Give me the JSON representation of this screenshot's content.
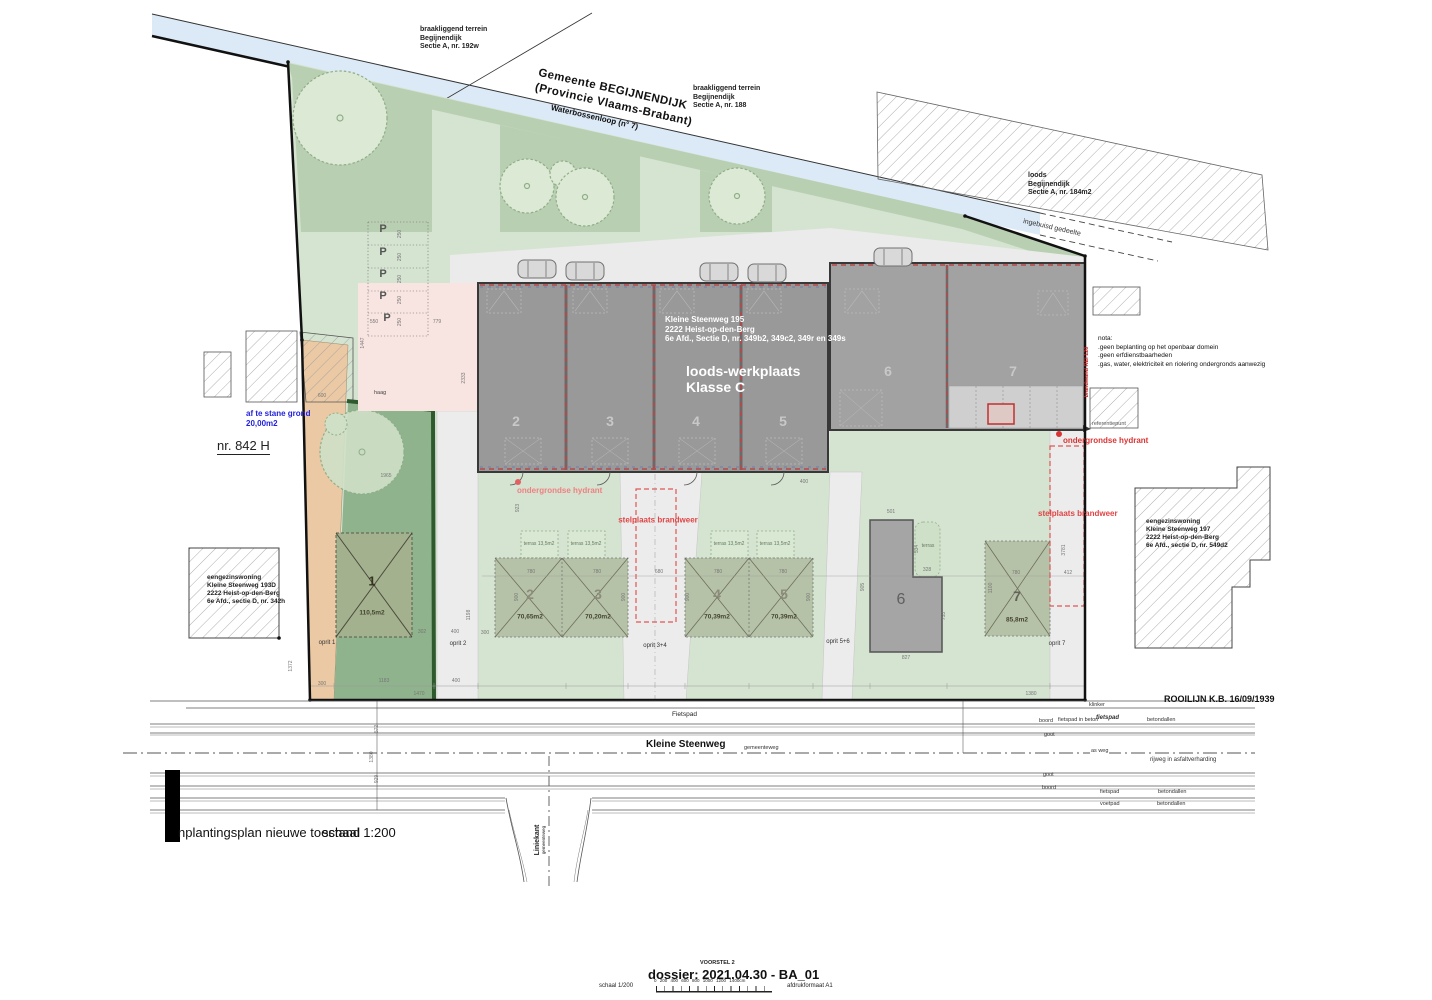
{
  "plan": {
    "parcel_nw": "braakliggend terrein\nBegijnendijk\nSectie A, nr. 192w",
    "parcel_n": "braakliggend terrein\nBegijnendijk\nSectie A, nr. 188",
    "parcel_ne": "loods\nBegijnendijk\nSectie A, nr. 184m2",
    "municipality_line1": "Gemeente BEGIJNENDIJK",
    "municipality_line2": "(Provincie Vlaams-Brabant)",
    "waterway": "Waterbossenloop (n° 7)",
    "buried_section": "ingebuisd gedeelte",
    "building_address": "Kleine Steenweg 195\n2222  Heist-op-den-Berg\n6e Afd., Sectie D, nr. 349b2, 349c2, 349r en 349s",
    "building_title": "loods-werkplaats\nKlasse C",
    "nota": "nota:\n.geen beplanting op het openbaar domein\n.geen erfdienstbaarheden\n.gas, water, elektriciteit en riolering ondergronds aanwezig",
    "firewall": "brandwand REI 120",
    "cede_land": "af te stane grond\n20,00m2",
    "parcel_nr": "nr. 842 H",
    "hedge": "haag",
    "hydrant_left": "ondergrondse hydrant",
    "hydrant_right": "ondergrondse hydrant",
    "reference_point": "referentiepunt",
    "fire_bay_center": "stelplaats brandweer",
    "fire_bay_right": "stelplaats brandweer",
    "house_left": "eengezinswoning\nKleine Steenweg 193D\n2222 Heist-op-den-Berg\n6e Afd., sectie D, nr. 342h",
    "house_right": "eengezinswoning\nKleine Steenweg 197\n2222 Heist-op-den-Berg\n6e Afd., sectie D, nr. 549d2"
  },
  "road": {
    "rooilijn": "ROOILIJN K.B. 16/09/1939",
    "fietspad": "Fietspad",
    "street_name": "Kleine Steenweg",
    "street_type": "gemeenteweg",
    "klinker": "klinker",
    "boord1": "boord",
    "boord2": "boord",
    "goot1": "goot",
    "goot2": "goot",
    "as_weg": "as weg",
    "rijweg": "rijweg in asfaltverharding",
    "fietspad_beton": "fietspad in beton",
    "fietspad_bold": "fietspad",
    "betondallen1": "betondallen",
    "betondallen2": "betondallen",
    "betondallen3": "betondallen",
    "fietspad2": "fietspad",
    "voetpad": "voetpad",
    "liniekant": "Liniekant",
    "liniekant_sub": "gemeenteweg"
  },
  "title_block": {
    "title": "nplantingsplan  nieuwe toestand",
    "scale": "schaal 1:200"
  },
  "footer": {
    "voorstel": "VOORSTEL 2",
    "dossier": "dossier: 2021.04.30  -  BA_01",
    "scale": "schaal 1/200",
    "ruler_labels": "0   200  400  600  800  1000 1200 1400cm",
    "format": "afdrukformaat A1"
  },
  "colors": {
    "water": "#dce9f6",
    "site_green": "#d5e3d1",
    "strip_green": "#b9cfb2",
    "building_gray": "#999999",
    "lot_green": "#8fb38c",
    "pink_zone": "#f8e4e0",
    "tan_drive": "#eac9a4",
    "red_accent": "#e04545",
    "blue_note": "#2222dd"
  },
  "annotations": {
    "p_label": "P",
    "p_marks": [
      {
        "x": 383,
        "y": 229
      },
      {
        "x": 383,
        "y": 252
      },
      {
        "x": 383,
        "y": 274
      },
      {
        "x": 383,
        "y": 296
      },
      {
        "x": 387,
        "y": 318
      }
    ],
    "stalls": [
      {
        "t": "2",
        "x": 516,
        "y": 421
      },
      {
        "t": "3",
        "x": 610,
        "y": 421
      },
      {
        "t": "4",
        "x": 696,
        "y": 421
      },
      {
        "t": "5",
        "x": 783,
        "y": 421
      },
      {
        "t": "6",
        "x": 888,
        "y": 371
      },
      {
        "t": "7",
        "x": 1013,
        "y": 371
      }
    ],
    "lots": [
      {
        "no": "1",
        "area": "110,5m2",
        "x": 372,
        "ny": 581,
        "ay": 613,
        "style": "dark"
      },
      {
        "no": "2",
        "area": "70,65m2",
        "x": 530,
        "ny": 594,
        "ay": 617,
        "style": "mid"
      },
      {
        "no": "3",
        "area": "70,20m2",
        "x": 598,
        "ny": 594,
        "ay": 617,
        "style": "mid"
      },
      {
        "no": "4",
        "area": "70,39m2",
        "x": 717,
        "ny": 594,
        "ay": 617,
        "style": "mid"
      },
      {
        "no": "5",
        "area": "70,39m2",
        "x": 784,
        "ny": 594,
        "ay": 617,
        "style": "mid"
      },
      {
        "no": "6",
        "area": "",
        "x": 901,
        "ny": 600,
        "ay": 0,
        "style": "onbldg"
      },
      {
        "no": "7",
        "area": "85,8m2",
        "x": 1017,
        "ny": 596,
        "ay": 620,
        "style": "mid7"
      }
    ],
    "terras": [
      {
        "t": "terras 13,5m2",
        "x": 539,
        "y": 544
      },
      {
        "t": "terras 13,5m2",
        "x": 586,
        "y": 544
      },
      {
        "t": "terras 13,5m2",
        "x": 729,
        "y": 544
      },
      {
        "t": "terras 13,5m2",
        "x": 775,
        "y": 544
      },
      {
        "t": "terras",
        "x": 928,
        "y": 546
      }
    ],
    "oprit": [
      {
        "t": "oprit 1",
        "x": 327,
        "y": 643
      },
      {
        "t": "oprit 2",
        "x": 458,
        "y": 644
      },
      {
        "t": "oprit 3+4",
        "x": 655,
        "y": 646
      },
      {
        "t": "oprit 5+6",
        "x": 838,
        "y": 642
      },
      {
        "t": "oprit 7",
        "x": 1057,
        "y": 644
      }
    ],
    "dims": [
      {
        "t": "600",
        "x": 322,
        "y": 396
      },
      {
        "t": "1965",
        "x": 386,
        "y": 476
      },
      {
        "t": "550",
        "x": 374,
        "y": 322
      },
      {
        "t": "779",
        "x": 437,
        "y": 322
      },
      {
        "t": "250",
        "x": 400,
        "y": 234,
        "v": 1
      },
      {
        "t": "250",
        "x": 400,
        "y": 257,
        "v": 1
      },
      {
        "t": "250",
        "x": 400,
        "y": 279,
        "v": 1
      },
      {
        "t": "250",
        "x": 400,
        "y": 300,
        "v": 1
      },
      {
        "t": "250",
        "x": 400,
        "y": 322,
        "v": 1
      },
      {
        "t": "1447",
        "x": 363,
        "y": 343,
        "v": 1
      },
      {
        "t": "2333",
        "x": 464,
        "y": 378,
        "v": 1
      },
      {
        "t": "300",
        "x": 322,
        "y": 684
      },
      {
        "t": "1183",
        "x": 384,
        "y": 681
      },
      {
        "t": "400",
        "x": 456,
        "y": 681
      },
      {
        "t": "1470",
        "x": 419,
        "y": 694
      },
      {
        "t": "302",
        "x": 422,
        "y": 632
      },
      {
        "t": "400",
        "x": 455,
        "y": 632
      },
      {
        "t": "1198",
        "x": 469,
        "y": 615,
        "v": 1
      },
      {
        "t": "780",
        "x": 531,
        "y": 572
      },
      {
        "t": "780",
        "x": 597,
        "y": 572
      },
      {
        "t": "680",
        "x": 659,
        "y": 572
      },
      {
        "t": "780",
        "x": 718,
        "y": 572
      },
      {
        "t": "780",
        "x": 783,
        "y": 572
      },
      {
        "t": "900",
        "x": 517,
        "y": 597,
        "v": 1
      },
      {
        "t": "900",
        "x": 624,
        "y": 597,
        "v": 1
      },
      {
        "t": "900",
        "x": 688,
        "y": 597,
        "v": 1
      },
      {
        "t": "900",
        "x": 809,
        "y": 597,
        "v": 1
      },
      {
        "t": "300",
        "x": 485,
        "y": 633
      },
      {
        "t": "400",
        "x": 804,
        "y": 482
      },
      {
        "t": "923",
        "x": 518,
        "y": 508,
        "v": 1
      },
      {
        "t": "501",
        "x": 891,
        "y": 512
      },
      {
        "t": "905",
        "x": 863,
        "y": 587,
        "v": 1
      },
      {
        "t": "534",
        "x": 917,
        "y": 549,
        "v": 1
      },
      {
        "t": "328",
        "x": 927,
        "y": 570
      },
      {
        "t": "753",
        "x": 944,
        "y": 616,
        "v": 1
      },
      {
        "t": "827",
        "x": 906,
        "y": 658
      },
      {
        "t": "780",
        "x": 1016,
        "y": 573
      },
      {
        "t": "1100",
        "x": 991,
        "y": 588,
        "v": 1
      },
      {
        "t": "412",
        "x": 1068,
        "y": 573
      },
      {
        "t": "3781",
        "x": 1064,
        "y": 550,
        "v": 1
      },
      {
        "t": "1372",
        "x": 291,
        "y": 666,
        "v": 1
      },
      {
        "t": "572",
        "x": 377,
        "y": 729,
        "v": 1
      },
      {
        "t": "1380",
        "x": 372,
        "y": 757,
        "v": 1
      },
      {
        "t": "929",
        "x": 377,
        "y": 779,
        "v": 1
      },
      {
        "t": "1380",
        "x": 1031,
        "y": 694
      }
    ]
  }
}
